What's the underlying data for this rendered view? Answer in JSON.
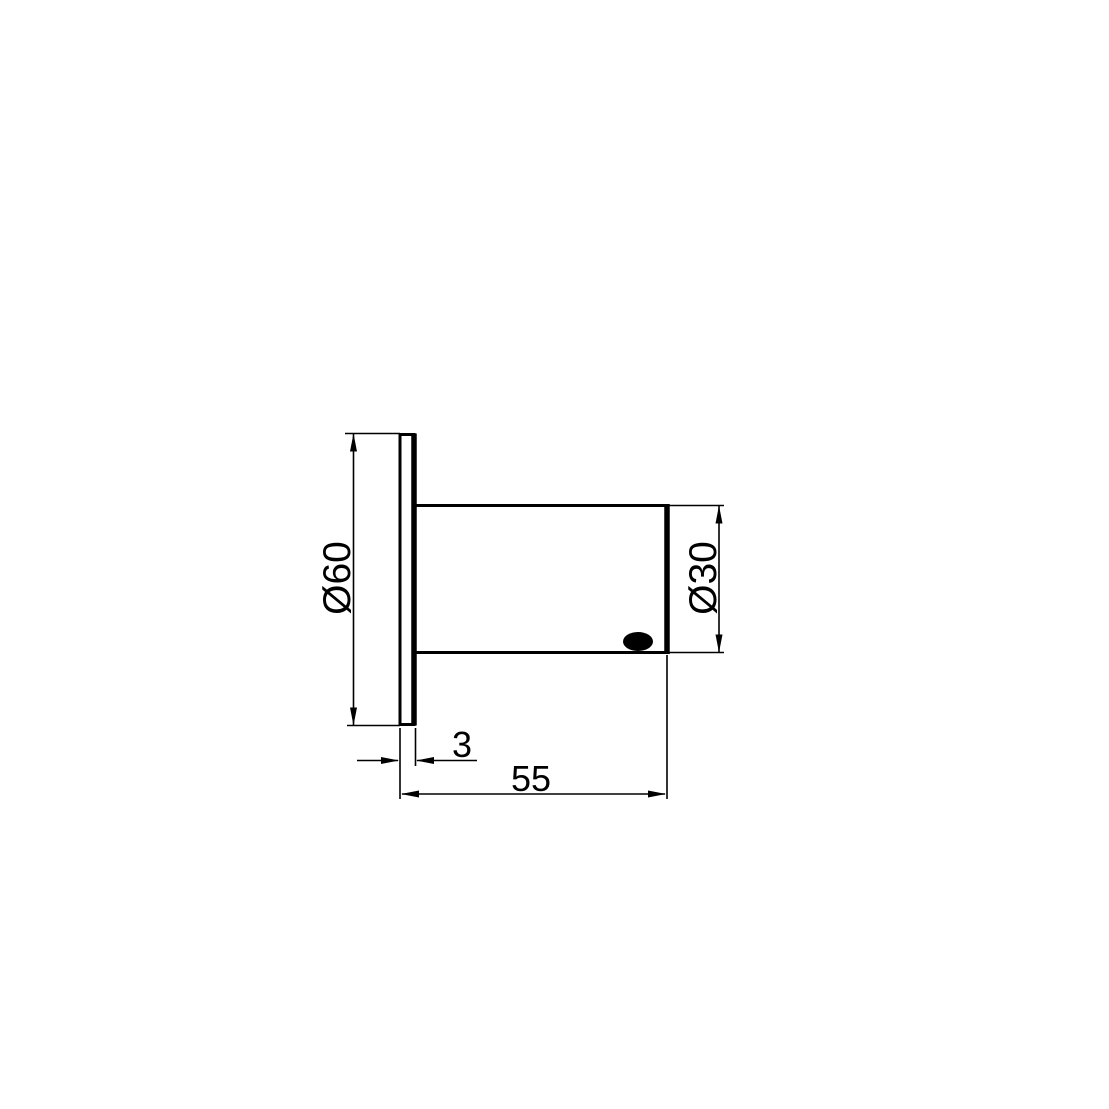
{
  "drawing": {
    "background_color": "#ffffff",
    "line_color": "#000000",
    "labels": {
      "flange_diameter": "Ø60",
      "body_diameter": "Ø30",
      "flange_thickness": "3",
      "overall_length": "55"
    }
  }
}
